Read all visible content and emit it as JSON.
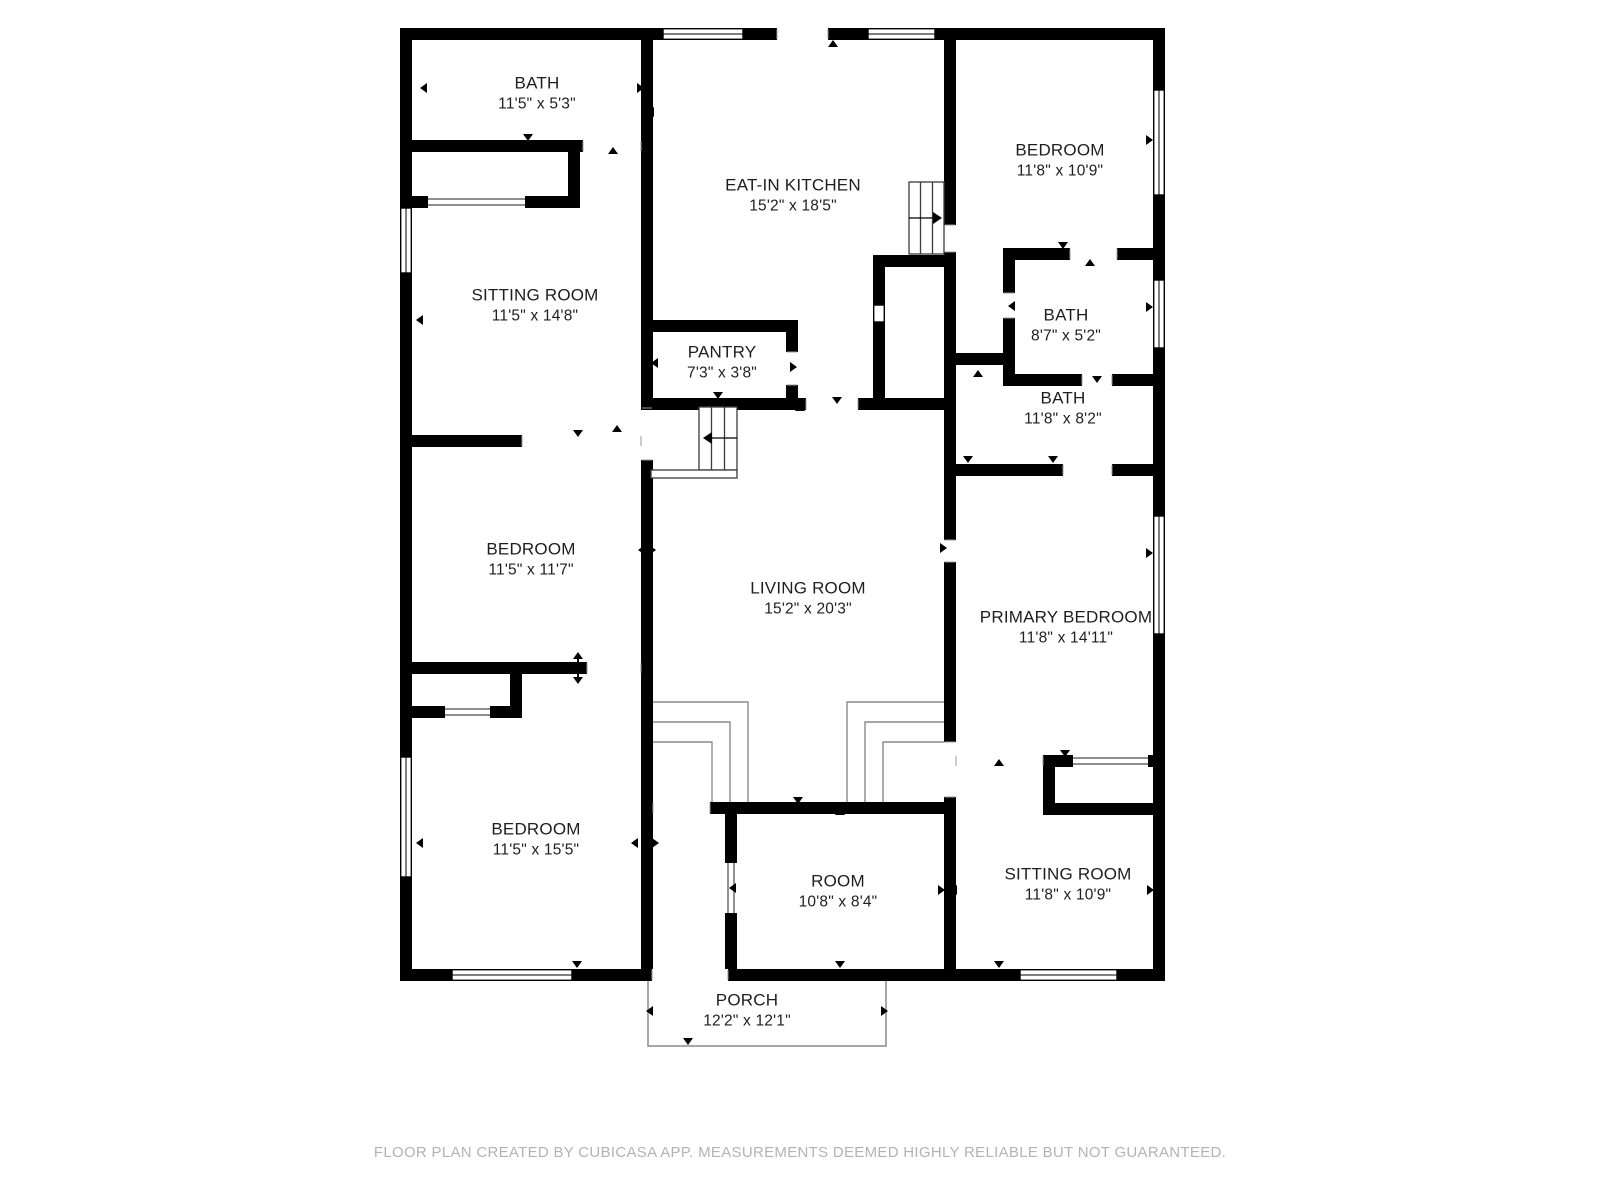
{
  "theme": {
    "background_color": "#ffffff",
    "wall_color": "#000000",
    "thin_line_color": "#8a8a8a",
    "label_color": "#1e1e1e",
    "footer_color": "#b3b3b3"
  },
  "floor_plan": {
    "source_app_note": "FLOOR PLAN CREATED BY CUBICASA APP. MEASUREMENTS DEEMED HIGHLY RELIABLE BUT NOT GUARANTEED.",
    "rooms": [
      {
        "id": "bath-top-left",
        "name": "BATH",
        "dims": "11'5\" x 5'3\"",
        "x": 537,
        "y": 93
      },
      {
        "id": "eat-in-kitchen",
        "name": "EAT-IN KITCHEN",
        "dims": "15'2\" x 18'5\"",
        "x": 793,
        "y": 195
      },
      {
        "id": "bedroom-top-right",
        "name": "BEDROOM",
        "dims": "11'8\" x 10'9\"",
        "x": 1060,
        "y": 160
      },
      {
        "id": "sitting-room-left",
        "name": "SITTING ROOM",
        "dims": "11'5\" x 14'8\"",
        "x": 535,
        "y": 305
      },
      {
        "id": "bath-right-small",
        "name": "BATH",
        "dims": "8'7\" x 5'2\"",
        "x": 1066,
        "y": 325
      },
      {
        "id": "pantry",
        "name": "PANTRY",
        "dims": "7'3\" x 3'8\"",
        "x": 722,
        "y": 362
      },
      {
        "id": "bath-right-large",
        "name": "BATH",
        "dims": "11'8\" x 8'2\"",
        "x": 1063,
        "y": 408
      },
      {
        "id": "bedroom-mid-left",
        "name": "BEDROOM",
        "dims": "11'5\" x 11'7\"",
        "x": 531,
        "y": 559
      },
      {
        "id": "living-room",
        "name": "LIVING ROOM",
        "dims": "15'2\" x 20'3\"",
        "x": 808,
        "y": 598
      },
      {
        "id": "primary-bedroom",
        "name": "PRIMARY BEDROOM",
        "dims": "11'8\" x 14'11\"",
        "x": 1066,
        "y": 627
      },
      {
        "id": "bedroom-bottom-left",
        "name": "BEDROOM",
        "dims": "11'5\" x 15'5\"",
        "x": 536,
        "y": 839
      },
      {
        "id": "room",
        "name": "ROOM",
        "dims": "10'8\" x 8'4\"",
        "x": 838,
        "y": 891
      },
      {
        "id": "sitting-room-bottom-right",
        "name": "SITTING ROOM",
        "dims": "11'8\" x 10'9\"",
        "x": 1068,
        "y": 884
      },
      {
        "id": "porch",
        "name": "PORCH",
        "dims": "12'2\" x 12'1\"",
        "x": 747,
        "y": 1010
      }
    ]
  },
  "footer": {
    "text": "FLOOR PLAN CREATED BY CUBICASA APP. MEASUREMENTS DEEMED HIGHLY RELIABLE BUT NOT GUARANTEED."
  }
}
